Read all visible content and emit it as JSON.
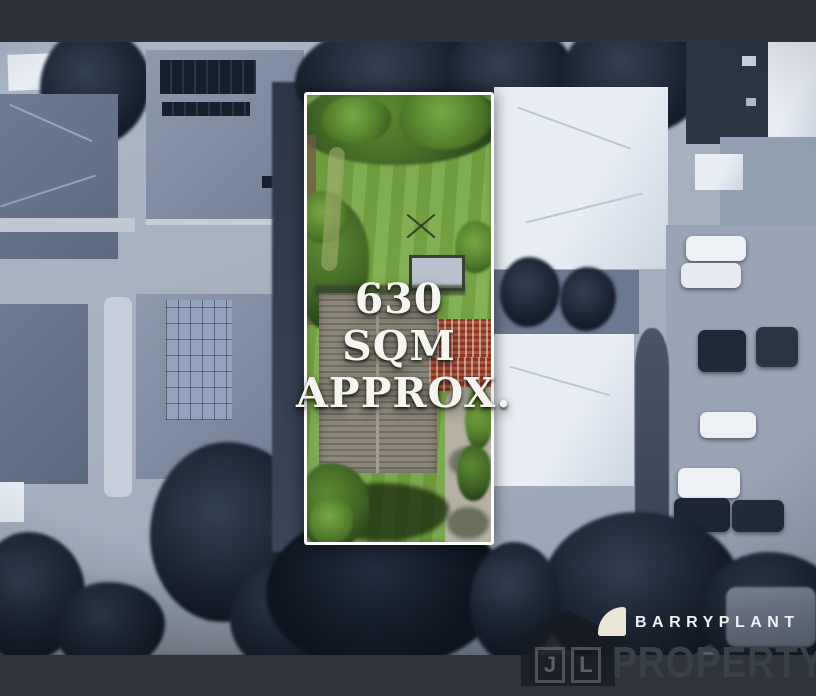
{
  "overlay": {
    "area_line1": "630 SQM",
    "area_line2": "APPROX."
  },
  "branding": {
    "agency_name": "BARRYPLANT",
    "sail_icon": "barryplant-sail-icon",
    "logo_color": "#ebe5d6",
    "name_color": "#eff1f4"
  },
  "watermark": {
    "house_icon": "house-icon",
    "monogram_left": "J",
    "monogram_right": "L",
    "text": "PROPERTY",
    "color": "#3a4048"
  },
  "colors": {
    "frame_top_bar": "#2e333b",
    "frame_bottom_bar": "#2f343a",
    "lot_border": "#ffffff",
    "lot_grass": "#74a643",
    "roof_shingle": "#8e897c",
    "roof_red_tile": "#ad5639",
    "surroundings_tint": "#a3aebf",
    "tree_dark": "#1a2332"
  }
}
